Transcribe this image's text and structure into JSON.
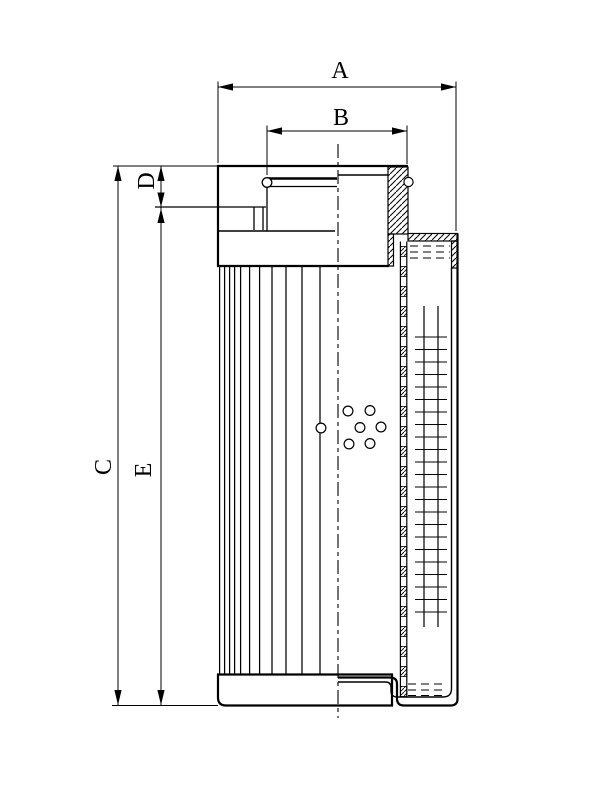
{
  "colors": {
    "ink": "#000000",
    "paper": "#ffffff"
  },
  "labels": {
    "dim_a": "A",
    "dim_b": "B",
    "dim_c": "C",
    "dim_d": "D",
    "dim_e": "E"
  },
  "geometry": {
    "pleat_lines_x": [
      219.6,
      224.6,
      229.6,
      234.6,
      240.6,
      249.6,
      259.6,
      272,
      286,
      302,
      320
    ],
    "pleat_y": [
      267,
      674.5
    ],
    "core_holes": {
      "r": 4.9,
      "centers": [
        [
          321,
          428
        ],
        [
          348,
          411
        ],
        [
          370,
          410.5
        ],
        [
          360,
          427.5
        ],
        [
          381,
          427
        ],
        [
          349,
          444
        ],
        [
          370,
          443.5
        ]
      ]
    },
    "core_tube": {
      "x1": 400.4,
      "x2": 406.8,
      "y1": 241.5,
      "y2": 697,
      "square_y0": 246.5,
      "square_step": 20,
      "square_h": 10,
      "square_count": 23
    },
    "mesh": {
      "verticals_x": [
        424,
        438
      ],
      "vert_y0": 306,
      "vert_y1": 627,
      "rung_x0": 415,
      "rung_x1": 447,
      "rung_y0": 337,
      "rung_y1": 612.5,
      "rung_step": 12.5
    },
    "oil_dashes_top": {
      "x": [
        410,
        450
      ],
      "rows": [
        246,
        252,
        258
      ]
    },
    "oil_dashes_bottom": {
      "x": [
        408,
        446
      ],
      "rows": [
        684,
        690,
        695.5
      ]
    }
  }
}
